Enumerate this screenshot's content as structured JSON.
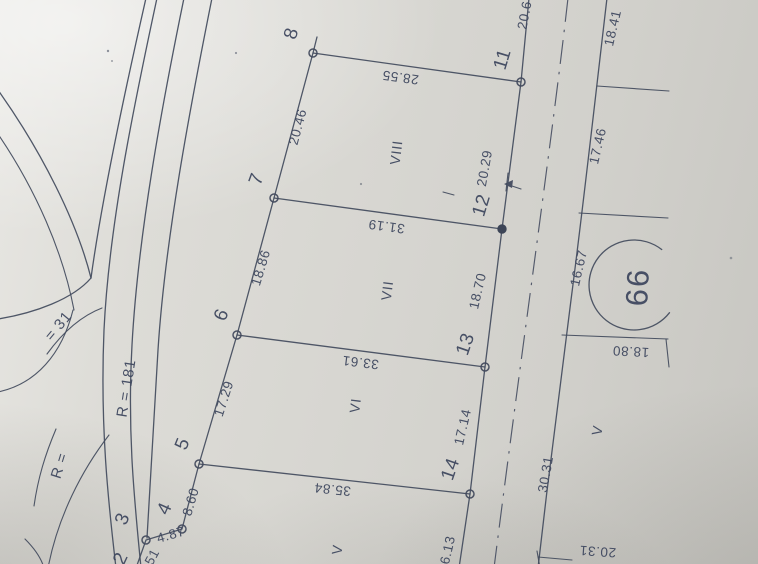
{
  "drawing": {
    "block_number": "66",
    "points": {
      "p2": "2",
      "p3": "3",
      "p4": "4",
      "p5": "5",
      "p6": "6",
      "p7": "7",
      "p8": "8",
      "p11": "11",
      "p12": "12",
      "p13": "13",
      "p14": "14"
    },
    "parcels": {
      "v": "V",
      "vi": "VI",
      "vii": "VII",
      "viii": "VIII",
      "v_across_road": "V"
    },
    "dimensions": {
      "d2_3": "51",
      "d3_4": "4.87",
      "d4_5": "8.60",
      "d5_6": "17.29",
      "d6_7": "18.86",
      "d7_8": "20.46",
      "d8_11": "28.55",
      "d7_12": "31.19",
      "d6_13": "33.61",
      "d5_14": "35.84",
      "d11_up": "20.6",
      "d11_12": "20.29",
      "d12_13": "18.70",
      "d13_14": "17.14",
      "d14_down": "6.13",
      "road_right_1": "18.41",
      "road_right_2": "17.46",
      "road_right_3": "16.67",
      "road_right_4": "18.80",
      "road_right_5": "30.31",
      "road_right_6": "20.31"
    },
    "radii": {
      "main_road": "R = 181",
      "branch_curve": "= 31",
      "corner_curve": "R ="
    },
    "colors": {
      "ink": "#434b5e",
      "paper": "#d7d6d1"
    }
  }
}
